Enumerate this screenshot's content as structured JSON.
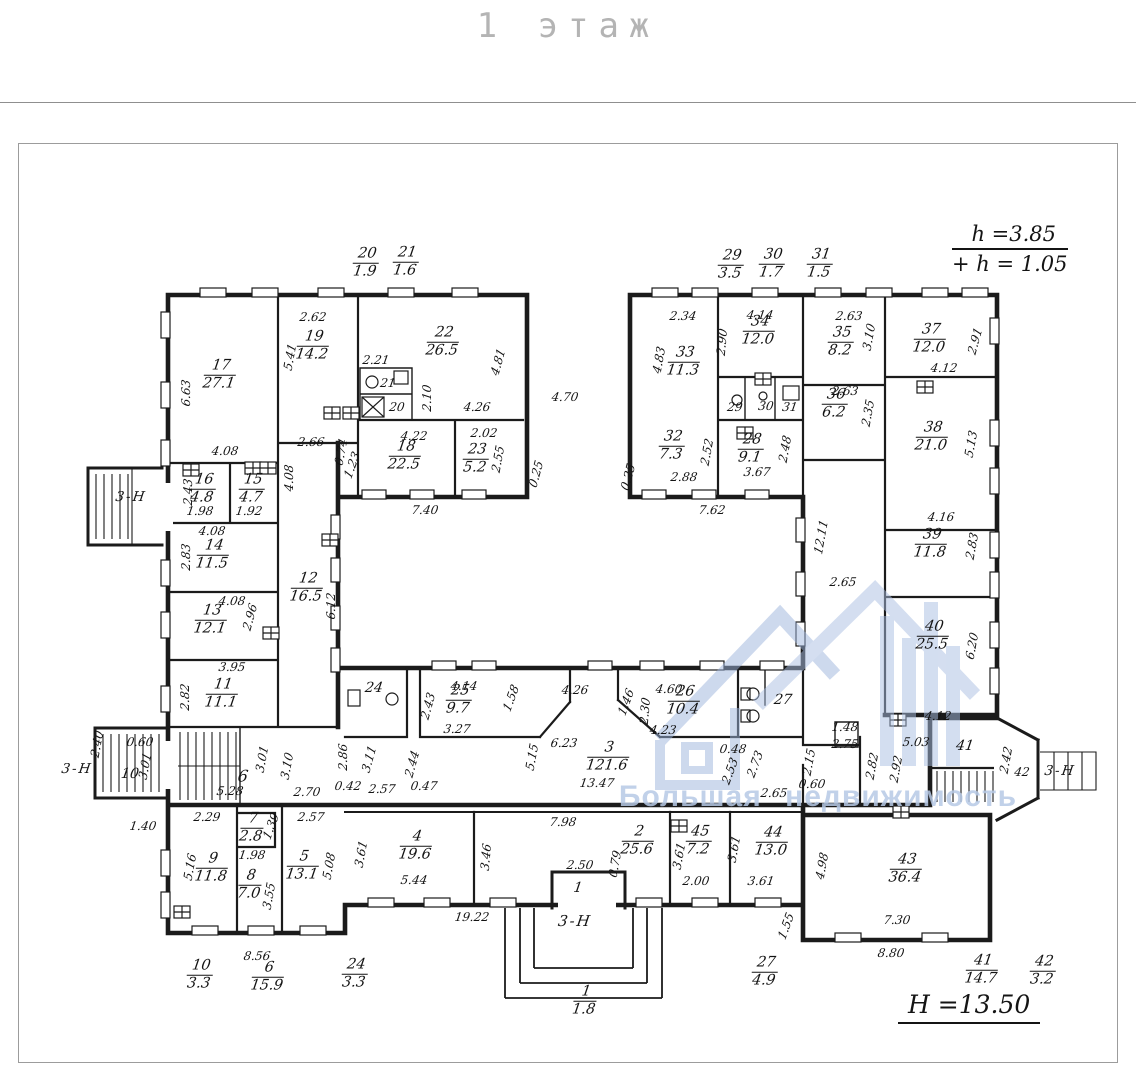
{
  "title": "1 этаж",
  "notes": {
    "h1": "h =3.85",
    "h2": "+ h = 1.05",
    "H": "H =13.50"
  },
  "watermark": {
    "text": "Большая недвижимость",
    "color": "#b7c9e6"
  },
  "plan": {
    "rooms": [
      {
        "n": "17",
        "a": "27.1",
        "x": 220,
        "y": 375
      },
      {
        "n": "19",
        "a": "14.2",
        "x": 313,
        "y": 346
      },
      {
        "n": "22",
        "a": "26.5",
        "x": 443,
        "y": 342
      },
      {
        "n": "18",
        "a": "22.5",
        "x": 405,
        "y": 456
      },
      {
        "n": "23",
        "a": "5.2",
        "x": 476,
        "y": 459
      },
      {
        "n": "16",
        "a": "4.8",
        "x": 203,
        "y": 489
      },
      {
        "n": "15",
        "a": "4.7",
        "x": 252,
        "y": 489
      },
      {
        "n": "14",
        "a": "11.5",
        "x": 213,
        "y": 555
      },
      {
        "n": "13",
        "a": "12.1",
        "x": 211,
        "y": 620
      },
      {
        "n": "11",
        "a": "11.1",
        "x": 222,
        "y": 694
      },
      {
        "n": "12",
        "a": "16.5",
        "x": 307,
        "y": 588
      },
      {
        "n": "33",
        "a": "11.3",
        "x": 684,
        "y": 362
      },
      {
        "n": "34",
        "a": "12.0",
        "x": 759,
        "y": 331
      },
      {
        "n": "35",
        "a": "8.2",
        "x": 841,
        "y": 342
      },
      {
        "n": "36",
        "a": "6.2",
        "x": 835,
        "y": 404
      },
      {
        "n": "32",
        "a": "7.3",
        "x": 672,
        "y": 446
      },
      {
        "n": "28",
        "a": "9.1",
        "x": 751,
        "y": 449
      },
      {
        "n": "37",
        "a": "12.0",
        "x": 930,
        "y": 339
      },
      {
        "n": "38",
        "a": "21.0",
        "x": 932,
        "y": 437
      },
      {
        "n": "39",
        "a": "11.8",
        "x": 931,
        "y": 544
      },
      {
        "n": "40",
        "a": "25.5",
        "x": 933,
        "y": 636
      },
      {
        "n": "25",
        "a": "9.7",
        "x": 459,
        "y": 700
      },
      {
        "n": "26",
        "a": "10.4",
        "x": 684,
        "y": 701
      },
      {
        "n": "3",
        "a": "121.6",
        "x": 608,
        "y": 757
      },
      {
        "n": "9",
        "a": "11.8",
        "x": 212,
        "y": 868
      },
      {
        "n": "8",
        "a": "7.0",
        "x": 250,
        "y": 885
      },
      {
        "n": "7",
        "a": "2.8",
        "x": 252,
        "y": 828
      },
      {
        "n": "5",
        "a": "13.1",
        "x": 303,
        "y": 866
      },
      {
        "n": "4",
        "a": "19.6",
        "x": 416,
        "y": 846
      },
      {
        "n": "2",
        "a": "25.6",
        "x": 638,
        "y": 841
      },
      {
        "n": "45",
        "a": "7.2",
        "x": 699,
        "y": 841
      },
      {
        "n": "44",
        "a": "13.0",
        "x": 772,
        "y": 842
      },
      {
        "n": "43",
        "a": "36.4",
        "x": 906,
        "y": 869
      }
    ],
    "outside_fractions": [
      {
        "n": "20",
        "a": "1.9",
        "x": 366,
        "y": 263
      },
      {
        "n": "21",
        "a": "1.6",
        "x": 406,
        "y": 262
      },
      {
        "n": "29",
        "a": "3.5",
        "x": 731,
        "y": 265
      },
      {
        "n": "30",
        "a": "1.7",
        "x": 772,
        "y": 264
      },
      {
        "n": "31",
        "a": "1.5",
        "x": 820,
        "y": 264
      },
      {
        "n": "10",
        "a": "3.3",
        "x": 200,
        "y": 975
      },
      {
        "n": "6",
        "a": "15.9",
        "x": 268,
        "y": 977
      },
      {
        "n": "24",
        "a": "3.3",
        "x": 355,
        "y": 974
      },
      {
        "n": "1",
        "a": "1.8",
        "x": 585,
        "y": 1001
      },
      {
        "n": "27",
        "a": "4.9",
        "x": 765,
        "y": 972
      },
      {
        "n": "41",
        "a": "14.7",
        "x": 982,
        "y": 970
      },
      {
        "n": "42",
        "a": "3.2",
        "x": 1043,
        "y": 971
      }
    ],
    "small_labels": [
      {
        "t": "21",
        "x": 388,
        "y": 383,
        "s": 12
      },
      {
        "t": "20",
        "x": 397,
        "y": 407,
        "s": 12
      },
      {
        "t": "29",
        "x": 735,
        "y": 407,
        "s": 12
      },
      {
        "t": "30",
        "x": 766,
        "y": 406,
        "s": 12
      },
      {
        "t": "31",
        "x": 790,
        "y": 407,
        "s": 12
      },
      {
        "t": "24",
        "x": 374,
        "y": 688,
        "s": 14
      },
      {
        "t": "27",
        "x": 783,
        "y": 700,
        "s": 14
      },
      {
        "t": "6",
        "x": 243,
        "y": 776,
        "s": 16
      },
      {
        "t": "10",
        "x": 130,
        "y": 774,
        "s": 14
      },
      {
        "t": "41",
        "x": 965,
        "y": 746,
        "s": 14
      },
      {
        "t": "42",
        "x": 1022,
        "y": 772,
        "s": 12
      },
      {
        "t": "1",
        "x": 578,
        "y": 888,
        "s": 14
      }
    ],
    "exit_labels": [
      {
        "t": "3-Н",
        "x": 131,
        "y": 497
      },
      {
        "t": "3-Н",
        "x": 77,
        "y": 769
      },
      {
        "t": "3-Н",
        "x": 1060,
        "y": 771
      },
      {
        "t": "3-Н",
        "x": 575,
        "y": 921,
        "s": 15
      }
    ],
    "dims": [
      {
        "t": "6.63",
        "x": 186,
        "y": 393,
        "r": -90
      },
      {
        "t": "2.62",
        "x": 313,
        "y": 317
      },
      {
        "t": "5.41",
        "x": 290,
        "y": 357,
        "r": -80
      },
      {
        "t": "2.21",
        "x": 376,
        "y": 360
      },
      {
        "t": "2.10",
        "x": 427,
        "y": 398,
        "r": -90
      },
      {
        "t": "4.81",
        "x": 498,
        "y": 362,
        "r": -75
      },
      {
        "t": "4.26",
        "x": 477,
        "y": 407
      },
      {
        "t": "2.66",
        "x": 311,
        "y": 442
      },
      {
        "t": "4.22",
        "x": 414,
        "y": 436
      },
      {
        "t": "2.02",
        "x": 484,
        "y": 433
      },
      {
        "t": "2.55",
        "x": 498,
        "y": 459,
        "r": -80
      },
      {
        "t": "7.40",
        "x": 425,
        "y": 510
      },
      {
        "t": "0.25",
        "x": 536,
        "y": 474,
        "r": -75
      },
      {
        "t": "0.74",
        "x": 341,
        "y": 452,
        "r": -80
      },
      {
        "t": "1.23",
        "x": 352,
        "y": 465,
        "r": -70
      },
      {
        "t": "4.08",
        "x": 289,
        "y": 478,
        "r": -90
      },
      {
        "t": "4.08",
        "x": 225,
        "y": 451
      },
      {
        "t": "4.08",
        "x": 212,
        "y": 531
      },
      {
        "t": "4.08",
        "x": 232,
        "y": 601
      },
      {
        "t": "2.43",
        "x": 188,
        "y": 492,
        "r": -90
      },
      {
        "t": "1.98",
        "x": 200,
        "y": 511
      },
      {
        "t": "1.92",
        "x": 249,
        "y": 511
      },
      {
        "t": "2.83",
        "x": 186,
        "y": 557,
        "r": -90
      },
      {
        "t": "2.96",
        "x": 250,
        "y": 617,
        "r": -75
      },
      {
        "t": "6.12",
        "x": 331,
        "y": 606,
        "r": -90
      },
      {
        "t": "3.95",
        "x": 232,
        "y": 667
      },
      {
        "t": "2.82",
        "x": 185,
        "y": 697,
        "r": -90
      },
      {
        "t": "4.70",
        "x": 565,
        "y": 397
      },
      {
        "t": "2.34",
        "x": 683,
        "y": 316
      },
      {
        "t": "4.14",
        "x": 760,
        "y": 315
      },
      {
        "t": "2.63",
        "x": 849,
        "y": 316
      },
      {
        "t": "3.10",
        "x": 869,
        "y": 337,
        "r": -80
      },
      {
        "t": "2.90",
        "x": 722,
        "y": 342,
        "r": -85
      },
      {
        "t": "4.83",
        "x": 659,
        "y": 360,
        "r": -80
      },
      {
        "t": "2.63",
        "x": 845,
        "y": 391
      },
      {
        "t": "2.35",
        "x": 868,
        "y": 413,
        "r": -80
      },
      {
        "t": "2.52",
        "x": 707,
        "y": 452,
        "r": -80
      },
      {
        "t": "2.48",
        "x": 785,
        "y": 449,
        "r": -80
      },
      {
        "t": "2.88",
        "x": 684,
        "y": 477
      },
      {
        "t": "3.67",
        "x": 757,
        "y": 472
      },
      {
        "t": "7.62",
        "x": 712,
        "y": 510
      },
      {
        "t": "0.25",
        "x": 628,
        "y": 477,
        "r": -75
      },
      {
        "t": "2.91",
        "x": 975,
        "y": 341,
        "r": -75
      },
      {
        "t": "4.12",
        "x": 944,
        "y": 368
      },
      {
        "t": "5.13",
        "x": 971,
        "y": 444,
        "r": -80
      },
      {
        "t": "4.16",
        "x": 941,
        "y": 517
      },
      {
        "t": "2.83",
        "x": 972,
        "y": 546,
        "r": -80
      },
      {
        "t": "6.20",
        "x": 972,
        "y": 646,
        "r": -80
      },
      {
        "t": "4.12",
        "x": 938,
        "y": 716
      },
      {
        "t": "5.03",
        "x": 916,
        "y": 742
      },
      {
        "t": "12.11",
        "x": 821,
        "y": 537,
        "r": -80
      },
      {
        "t": "2.65",
        "x": 843,
        "y": 582
      },
      {
        "t": "4.14",
        "x": 464,
        "y": 686
      },
      {
        "t": "2.43",
        "x": 428,
        "y": 706,
        "r": -75
      },
      {
        "t": "3.27",
        "x": 457,
        "y": 729
      },
      {
        "t": "1.58",
        "x": 511,
        "y": 698,
        "r": -70
      },
      {
        "t": "4.26",
        "x": 575,
        "y": 690
      },
      {
        "t": "6.23",
        "x": 564,
        "y": 743
      },
      {
        "t": "5.15",
        "x": 532,
        "y": 757,
        "r": -80
      },
      {
        "t": "13.47",
        "x": 597,
        "y": 783
      },
      {
        "t": "7.98",
        "x": 563,
        "y": 822
      },
      {
        "t": "4.60",
        "x": 669,
        "y": 689
      },
      {
        "t": "2.30",
        "x": 645,
        "y": 711,
        "r": -85
      },
      {
        "t": "4.23",
        "x": 663,
        "y": 730
      },
      {
        "t": "1.46",
        "x": 626,
        "y": 702,
        "r": -70
      },
      {
        "t": "0.48",
        "x": 733,
        "y": 749
      },
      {
        "t": "2.53",
        "x": 730,
        "y": 771,
        "r": -70
      },
      {
        "t": "2.73",
        "x": 755,
        "y": 764,
        "r": -70
      },
      {
        "t": "2.15",
        "x": 809,
        "y": 762,
        "r": -80
      },
      {
        "t": "0.60",
        "x": 812,
        "y": 784
      },
      {
        "t": "2.65",
        "x": 774,
        "y": 793
      },
      {
        "t": "1.48",
        "x": 845,
        "y": 727
      },
      {
        "t": "2.75",
        "x": 845,
        "y": 744
      },
      {
        "t": "2.82",
        "x": 872,
        "y": 766,
        "r": -80
      },
      {
        "t": "2.92",
        "x": 896,
        "y": 769,
        "r": -80
      },
      {
        "t": "2.86",
        "x": 343,
        "y": 757,
        "r": -90
      },
      {
        "t": "3.11",
        "x": 369,
        "y": 759,
        "r": -75
      },
      {
        "t": "2.44",
        "x": 412,
        "y": 764,
        "r": -75
      },
      {
        "t": "0.42",
        "x": 348,
        "y": 786
      },
      {
        "t": "2.57",
        "x": 382,
        "y": 789
      },
      {
        "t": "0.47",
        "x": 424,
        "y": 786
      },
      {
        "t": "0.60",
        "x": 140,
        "y": 742
      },
      {
        "t": "3.01",
        "x": 145,
        "y": 766,
        "r": -80
      },
      {
        "t": "2.40",
        "x": 97,
        "y": 744,
        "r": -80
      },
      {
        "t": "3.01",
        "x": 262,
        "y": 759,
        "r": -80
      },
      {
        "t": "3.10",
        "x": 287,
        "y": 766,
        "r": -80
      },
      {
        "t": "5.28",
        "x": 230,
        "y": 791
      },
      {
        "t": "2.70",
        "x": 307,
        "y": 792
      },
      {
        "t": "1.40",
        "x": 143,
        "y": 826
      },
      {
        "t": "2.29",
        "x": 207,
        "y": 817
      },
      {
        "t": "1.39",
        "x": 271,
        "y": 826,
        "r": -70
      },
      {
        "t": "2.57",
        "x": 311,
        "y": 817
      },
      {
        "t": "1.98",
        "x": 252,
        "y": 855
      },
      {
        "t": "5.16",
        "x": 190,
        "y": 867,
        "r": -80
      },
      {
        "t": "3.55",
        "x": 269,
        "y": 896,
        "r": -80
      },
      {
        "t": "5.08",
        "x": 329,
        "y": 866,
        "r": -80
      },
      {
        "t": "8.56",
        "x": 257,
        "y": 956
      },
      {
        "t": "3.61",
        "x": 361,
        "y": 854,
        "r": -80
      },
      {
        "t": "5.44",
        "x": 414,
        "y": 880
      },
      {
        "t": "3.46",
        "x": 486,
        "y": 857,
        "r": -85
      },
      {
        "t": "19.22",
        "x": 472,
        "y": 917
      },
      {
        "t": "2.50",
        "x": 580,
        "y": 865
      },
      {
        "t": "0.79",
        "x": 615,
        "y": 864,
        "r": -80
      },
      {
        "t": "3.61",
        "x": 679,
        "y": 856,
        "r": -80
      },
      {
        "t": "2.00",
        "x": 696,
        "y": 881
      },
      {
        "t": "3.61",
        "x": 734,
        "y": 849,
        "r": -80
      },
      {
        "t": "3.61",
        "x": 761,
        "y": 881
      },
      {
        "t": "1.55",
        "x": 786,
        "y": 926,
        "r": -70
      },
      {
        "t": "4.98",
        "x": 822,
        "y": 866,
        "r": -80
      },
      {
        "t": "7.30",
        "x": 897,
        "y": 920
      },
      {
        "t": "8.80",
        "x": 891,
        "y": 953
      },
      {
        "t": "2.42",
        "x": 1006,
        "y": 760,
        "r": -80
      }
    ]
  }
}
